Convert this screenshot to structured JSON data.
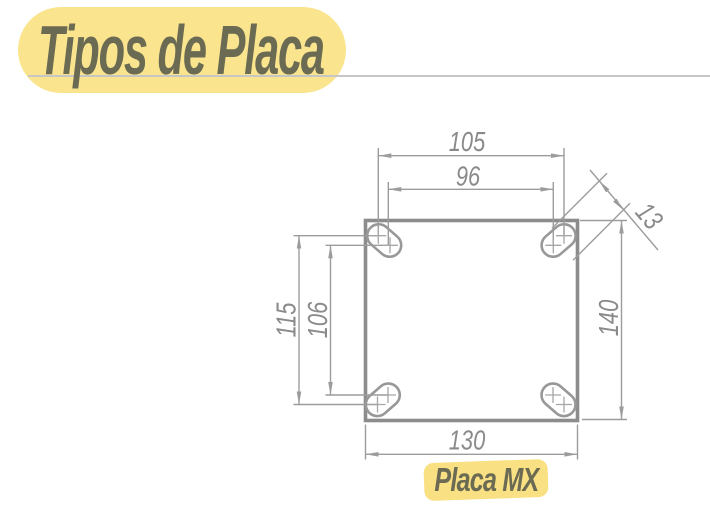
{
  "header": {
    "title": "Tipos de Placa"
  },
  "diagram": {
    "caption": "Placa MX",
    "dimensions": {
      "hole_spacing_outer_h": "105",
      "hole_spacing_inner_h": "96",
      "hole_spacing_outer_v": "115",
      "hole_spacing_inner_v": "106",
      "plate_height": "140",
      "plate_width": "130",
      "slot_width": "13"
    }
  },
  "colors": {
    "highlight_yellow": "#FAE58E",
    "caption_yellow": "#F8E083",
    "text_olive": "#6B6A53",
    "underline_gray": "#C6C6C6",
    "plate_outline_gray": "#8C8C8C",
    "line_gray": "#9C9C9C",
    "dim_text_gray": "#8A8A8A"
  }
}
